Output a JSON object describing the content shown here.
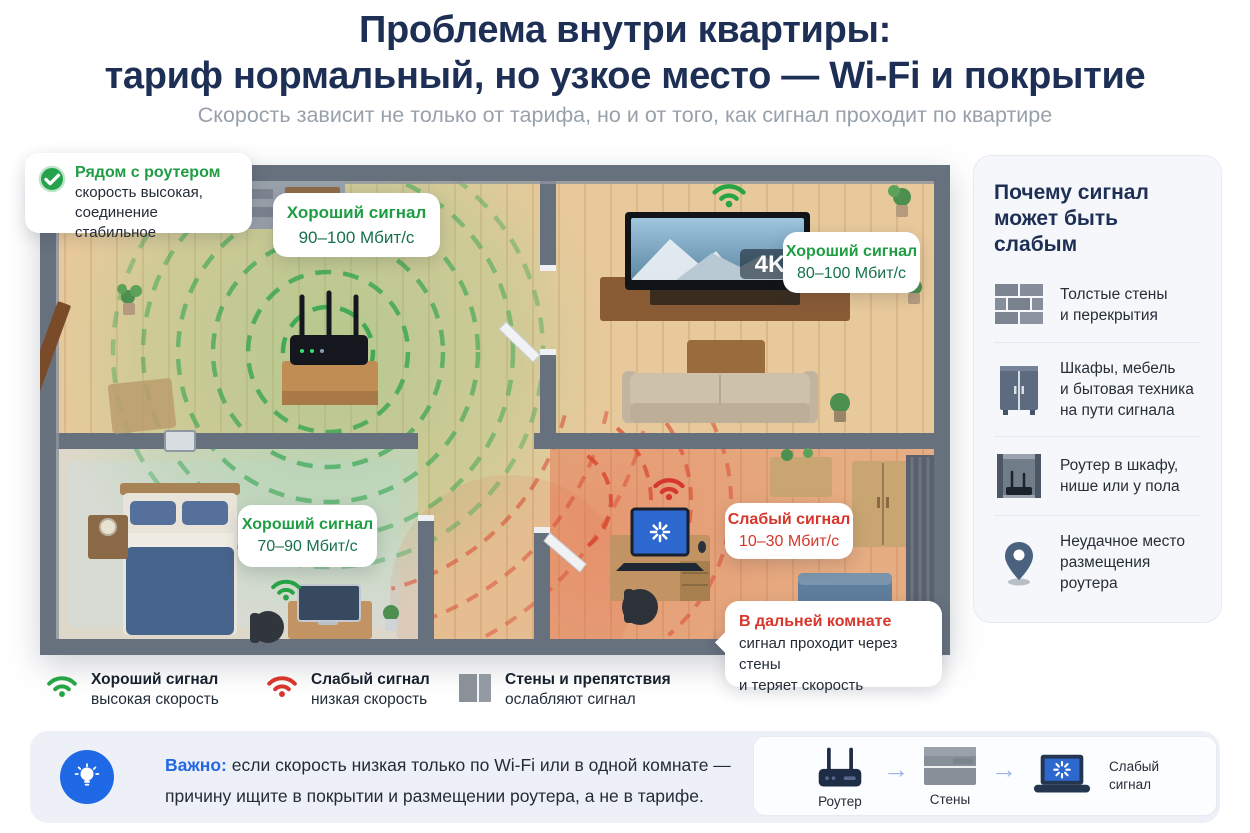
{
  "header": {
    "title_line1": "Проблема внутри квартиры:",
    "title_line2": "тариф нормальный, но узкое место — Wi-Fi и покрытие",
    "subtitle": "Скорость зависит не только от тарифа, но и от того, как сигнал проходит по квартире"
  },
  "floorplan": {
    "tv_badge": "4K",
    "router_callout": {
      "title": "Рядом с роутером",
      "line1": "скорость высокая,",
      "line2": "соединение стабильное"
    },
    "badge_hall": {
      "title": "Хороший сигнал",
      "value": "90–100 Мбит/с"
    },
    "badge_living": {
      "title": "Хороший сигнал",
      "value": "80–100 Мбит/с"
    },
    "badge_bedroom": {
      "title": "Хороший сигнал",
      "value": "70–90 Мбит/с"
    },
    "badge_far": {
      "title": "Слабый сигнал",
      "value": "10–30 Мбит/с"
    },
    "far_callout": {
      "title": "В дальней комнате",
      "line1": "сигнал проходит через стены",
      "line2": "и теряет скорость"
    }
  },
  "sidebar": {
    "title_line1": "Почему сигнал",
    "title_line2": "может быть слабым",
    "items": [
      {
        "icon": "brick-wall-icon",
        "lines": [
          "Толстые стены",
          "и перекрытия"
        ]
      },
      {
        "icon": "cabinet-icon",
        "lines": [
          "Шкафы, мебель",
          "и бытовая техника",
          "на пути сигнала"
        ]
      },
      {
        "icon": "router-in-shelf-icon",
        "lines": [
          "Роутер в шкафу,",
          "нише или у пола"
        ]
      },
      {
        "icon": "map-pin-icon",
        "lines": [
          "Неудачное место",
          "размещения роутера"
        ]
      }
    ]
  },
  "legend": {
    "good": {
      "title": "Хороший сигнал",
      "subtitle": "высокая скорость"
    },
    "weak": {
      "title": "Слабый сигнал",
      "subtitle": "низкая скорость"
    },
    "walls": {
      "title": "Стены и препятствия",
      "subtitle": "ослабляют сигнал"
    }
  },
  "banner": {
    "label": "Важно:",
    "line1": "если скорость низкая только по Wi-Fi или в одной комнате —",
    "line2": "причину ищите в покрытии и размещении роутера, а не в тарифе.",
    "flow": {
      "router": "Роутер",
      "walls": "Стены",
      "result_line1": "Слабый",
      "result_line2": "сигнал"
    }
  },
  "colors": {
    "green": "#21a044",
    "red": "#d6362b",
    "navy": "#1e2f55",
    "blue": "#2468e4"
  }
}
